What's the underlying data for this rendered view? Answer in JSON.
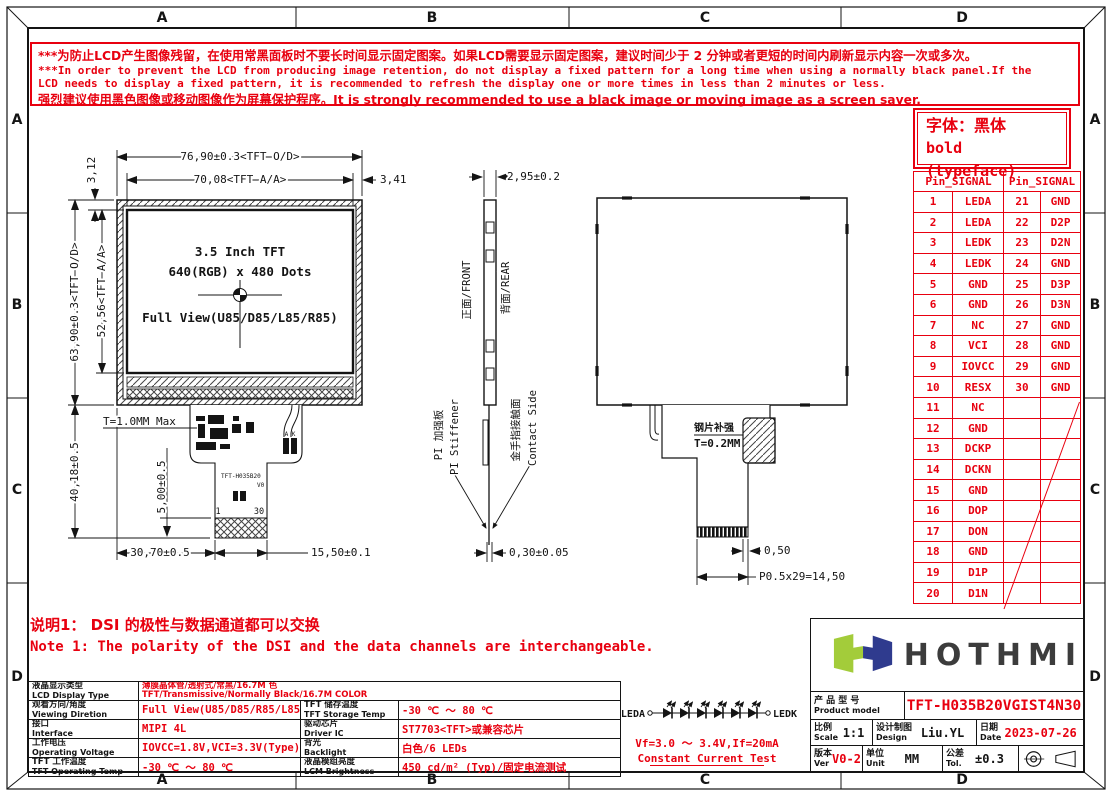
{
  "colors": {
    "red": "#e8000f",
    "black": "#141414",
    "logo_green": "#a3cc3a",
    "logo_navy": "#2f3b8e"
  },
  "border": {
    "zones": [
      "A",
      "B",
      "C",
      "D"
    ]
  },
  "warning": {
    "l1": "***为防止LCD产生图像残留，在使用常黑面板时不要长时间显示固定图案。如果LCD需要显示固定图案，建议时间少于 2 分钟或者更短的时间内刷新显示内容一次或多次。",
    "l2": "***In order to prevent the LCD from producing image retention, do not display a fixed pattern for a long time when using a normally black panel.If the",
    "l3": " LCD needs to display a fixed pattern,  it is recommended to refresh the display one or more times in less than 2 minutes or less.",
    "l4": "强烈建议使用黑色图像或移动图像作为屏幕保护程序。It is strongly recommended to use a black image or moving image as a screen saver."
  },
  "typeface_note": {
    "l1": "字体：黑体",
    "l2": "bold (typeface)"
  },
  "pin_table": {
    "header_left": "Pin_SIGNAL",
    "header_right": "Pin_SIGNAL",
    "rows": [
      [
        "1",
        "LEDA",
        "21",
        "GND"
      ],
      [
        "2",
        "LEDA",
        "22",
        "D2P"
      ],
      [
        "3",
        "LEDK",
        "23",
        "D2N"
      ],
      [
        "4",
        "LEDK",
        "24",
        "GND"
      ],
      [
        "5",
        "GND",
        "25",
        "D3P"
      ],
      [
        "6",
        "GND",
        "26",
        "D3N"
      ],
      [
        "7",
        "NC",
        "27",
        "GND"
      ],
      [
        "8",
        "VCI",
        "28",
        "GND"
      ],
      [
        "9",
        "IOVCC",
        "29",
        "GND"
      ],
      [
        "10",
        "RESX",
        "30",
        "GND"
      ],
      [
        "11",
        "NC",
        "",
        ""
      ],
      [
        "12",
        "GND",
        "",
        ""
      ],
      [
        "13",
        "DCKP",
        "",
        ""
      ],
      [
        "14",
        "DCKN",
        "",
        ""
      ],
      [
        "15",
        "GND",
        "",
        ""
      ],
      [
        "16",
        "DOP",
        "",
        ""
      ],
      [
        "17",
        "DON",
        "",
        ""
      ],
      [
        "18",
        "GND",
        "",
        ""
      ],
      [
        "19",
        "D1P",
        "",
        ""
      ],
      [
        "20",
        "D1N",
        "",
        ""
      ]
    ]
  },
  "front_view": {
    "dim_width_od": "76,90±0.3<TFT O/D>",
    "dim_width_aa": "70,08<TFT A/A>",
    "dim_border_right": "3,41",
    "dim_border_top": "3,12",
    "dim_height_od": "63,90±0.3<TFT O/D>",
    "dim_height_aa": "52,56<TFT A/A>",
    "dim_module_total": "40,18±0.5",
    "dim_fpc": "5,00±0.5",
    "dim_fpc_left": "30,70±0.5",
    "dim_fpc_width": "15,50±0.1",
    "thickness": "T=1.0MM Max",
    "line1": "3.5 Inch TFT",
    "line2": "640(RGB) x 480 Dots",
    "line3": "Full View(U85/D85/L85/R85)",
    "fpc_model": "TFT-H035B20",
    "fpc_ver": "V0",
    "pin1": "1",
    "pin30": "30",
    "bl_pads": "A K"
  },
  "side_view": {
    "dim_thickness": "2,95±0.2",
    "front": "正面/FRONT",
    "rear": "背面/REAR",
    "stiffener_en": "PI Stiffener",
    "stiffener_cn": "PI 加强板",
    "contact_en": "Contact Side",
    "contact_cn": "金手指接触面",
    "dim_fpc": "0,30±0.05"
  },
  "rear_view": {
    "steel_cn": "钢片补强",
    "steel_t": "T=0.2MM",
    "dim_pitch": "0,50",
    "dim_total": "P0.5x29=14,50"
  },
  "note": {
    "cn": "说明1：  DSI 的极性与数据通道都可以交换",
    "en": "Note 1: The polarity of the DSI and the data channels are interchangeable."
  },
  "led": {
    "anode": "LEDA",
    "cathode": "LEDK",
    "vf": "Vf=3.0 ～ 3.4V,If=20mA",
    "test": "Constant Current Test"
  },
  "spec_table": {
    "row1": {
      "label_cn": "液晶显示类型",
      "label_en": "LCD Display Type",
      "value_cn": "薄膜晶体管/透射式/常黑/16.7M 色",
      "value_en": "TFT/Transmissive/Normally Black/16.7M COLOR"
    },
    "rows": [
      {
        "l1_cn": "观看方向/角度",
        "l1_en": "Viewing Diretion",
        "v1": "Full View(U85/D85/R85/L85)",
        "l2_cn": "TFT 储存温度",
        "l2_en": "TFT Storage Temp",
        "v2": "-30 ℃ ～ 80 ℃"
      },
      {
        "l1_cn": "接口",
        "l1_en": "Interface",
        "v1": "MIPI 4L",
        "l2_cn": "驱动芯片",
        "l2_en": "Driver IC",
        "v2": "ST7703<TFT>或兼容芯片"
      },
      {
        "l1_cn": "工作电压",
        "l1_en": "Operating Voltage",
        "v1": "IOVCC=1.8V,VCI=3.3V(Type)",
        "l2_cn": "背光",
        "l2_en": "Backlight",
        "v2": "白色/6 LEDs"
      },
      {
        "l1_cn": "TFT 工作温度",
        "l1_en": "TFT Operating Temp",
        "v1": "-30 ℃ ～ 80 ℃",
        "l2_cn": "液晶模组亮度",
        "l2_en": "LCM Brightness",
        "v2": "450 cd/m² (Typ)/固定电流测试"
      }
    ]
  },
  "title_block": {
    "brand": "HOTHMI",
    "product_label_cn": "产 品 型 号",
    "product_label_en": "Product model",
    "product_model": "TFT-H035B20VGIST4N30",
    "scale_cn": "比例",
    "scale_en": "Scale",
    "scale_val": "1:1",
    "design_cn": "设计制图",
    "design_en": "Design",
    "design_val": "Liu.YL",
    "date_cn": "日期",
    "date_en": "Date",
    "date_val": "2023-07-26",
    "ver_cn": "版本",
    "ver_en": "Ver",
    "ver_val": "V0-2",
    "unit_cn": "单位",
    "unit_en": "Unit",
    "unit_val": "MM",
    "tol_cn": "公差",
    "tol_en": "Tol.",
    "tol_val": "±0.3"
  }
}
